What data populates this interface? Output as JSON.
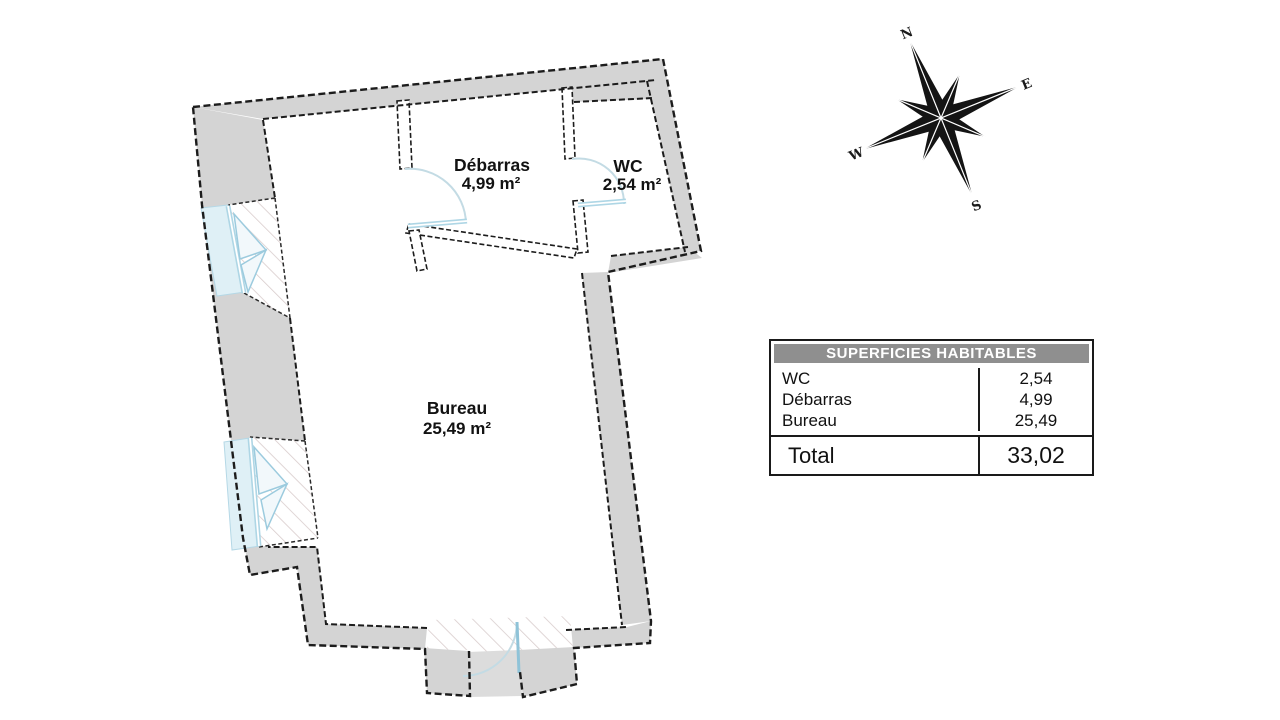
{
  "plan": {
    "rooms": [
      {
        "name": "Débarras",
        "area": "4,99 m²"
      },
      {
        "name": "WC",
        "area": "2,54 m²"
      },
      {
        "name": "Bureau",
        "area": "25,49 m²"
      }
    ]
  },
  "compass": {
    "north": "N",
    "east": "E",
    "south": "S",
    "west": "W"
  },
  "table": {
    "header": "SUPERFICIES HABITABLES",
    "rows": [
      {
        "label": "WC",
        "value": "2,54"
      },
      {
        "label": "Débarras",
        "value": "4,99"
      },
      {
        "label": "Bureau",
        "value": "25,49"
      }
    ],
    "total": {
      "label": "Total",
      "value": "33,02"
    }
  },
  "colors": {
    "wall_gray": "#d4d4d4",
    "outline_black": "#1c1c1c",
    "accent_blue": "#8fc3d8",
    "hatch_gray": "#d8cccc",
    "table_header_gray": "#8f8f8f"
  }
}
